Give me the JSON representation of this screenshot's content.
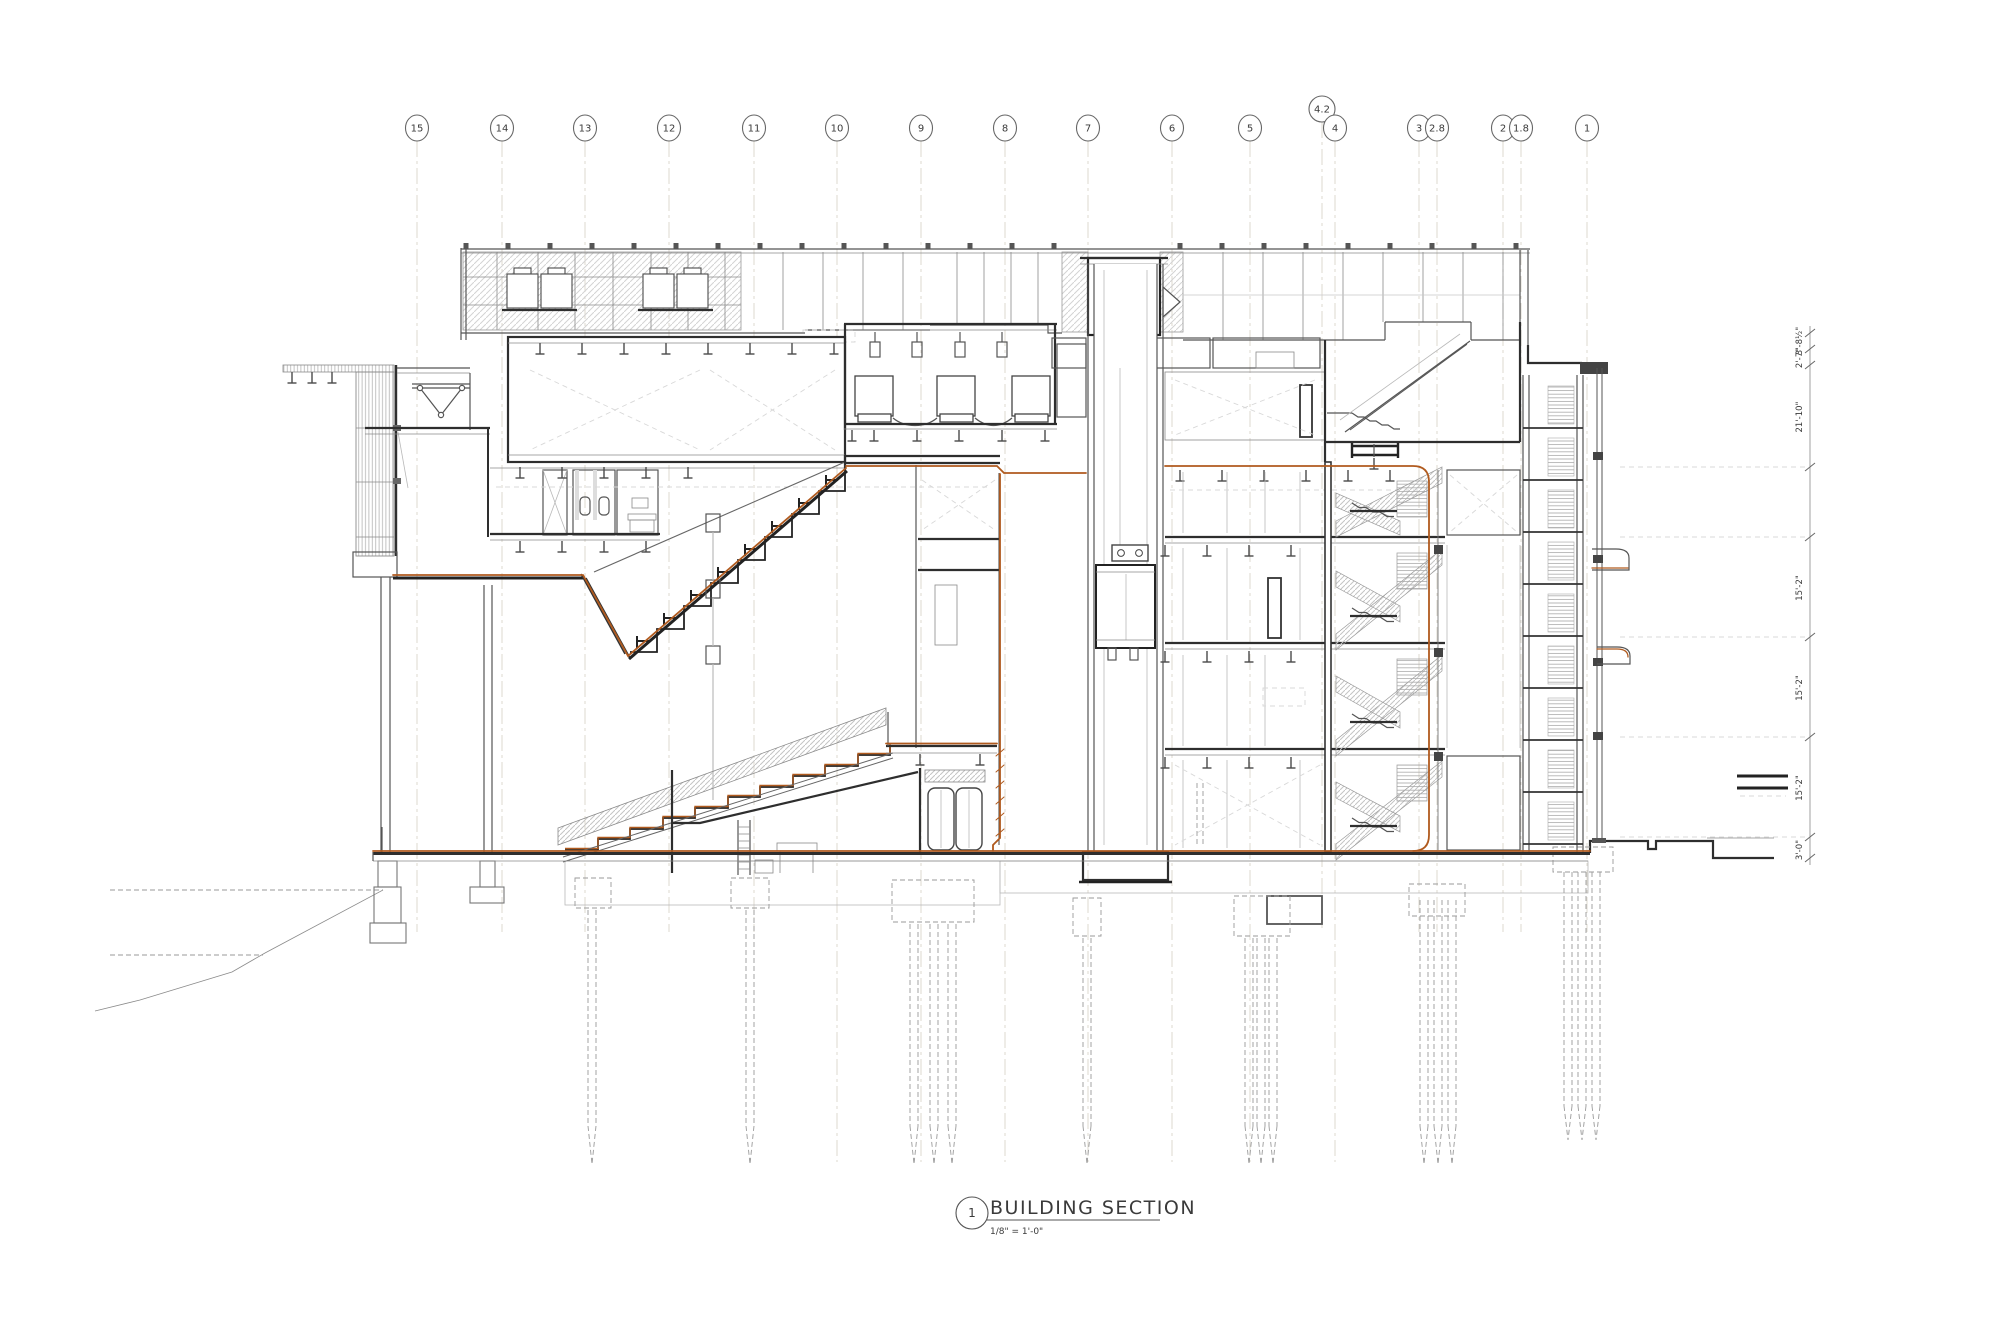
{
  "drawing": {
    "title_block": {
      "number": "1",
      "title": "BUILDING SECTION",
      "scale": "1/8\" = 1'-0\""
    },
    "grid": {
      "bubbles": [
        "15",
        "14",
        "13",
        "12",
        "11",
        "10",
        "9",
        "8",
        "7",
        "6",
        "5",
        "4.2",
        "4",
        "3",
        "2.8",
        "2",
        "1.8",
        "1"
      ]
    },
    "dimensions": {
      "labels": [
        "3'-8½\"",
        "2'-7\"",
        "21'-10\"",
        "15'-2\"",
        "15'-2\"",
        "15'-2\"",
        "3'-0\""
      ]
    },
    "colors": {
      "accent_orange": "#B05A1E",
      "line_dark": "#3A3A3A",
      "hatch_gray": "#C9C9C9"
    }
  }
}
